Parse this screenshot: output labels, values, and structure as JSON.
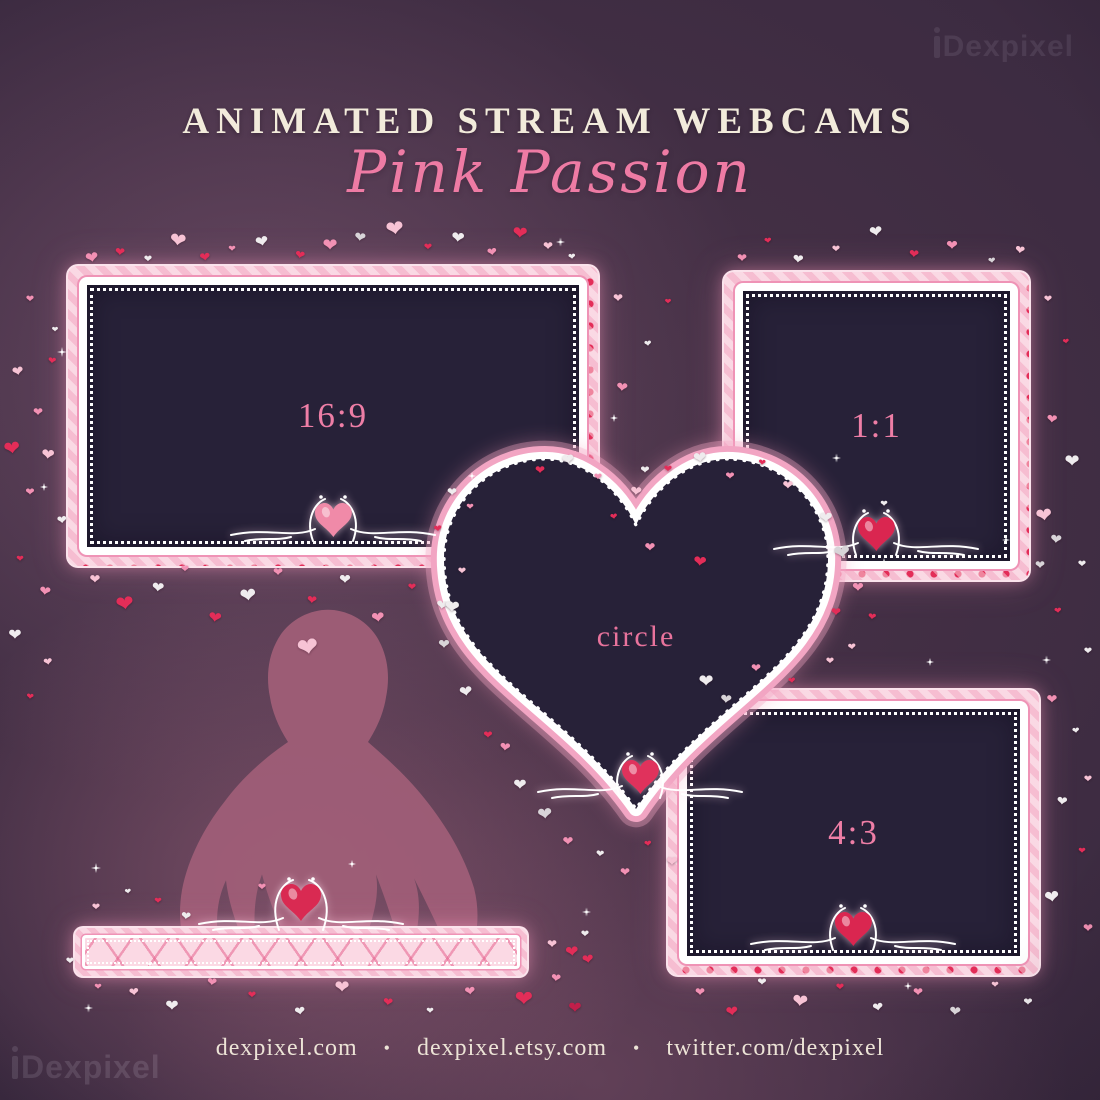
{
  "watermark": {
    "text": "Dexpixel"
  },
  "header": {
    "title": "ANIMATED STREAM WEBCAMS",
    "subtitle": "Pink Passion"
  },
  "frames": [
    {
      "id": "16-9",
      "label": "16:9",
      "ornament_color": "#f08aa8"
    },
    {
      "id": "1-1",
      "label": "1:1",
      "ornament_color": "#da2650"
    },
    {
      "id": "circle",
      "label": "circle",
      "ornament_color": "#e0325c"
    },
    {
      "id": "4-3",
      "label": "4:3",
      "ornament_color": "#da2650"
    },
    {
      "id": "label-bar",
      "label": "",
      "ornament_color": "#d92a52"
    }
  ],
  "footer": {
    "separator": "•",
    "links": [
      "dexpixel.com",
      "dexpixel.etsy.com",
      "twitter.com/dexpixel"
    ]
  },
  "colors": {
    "background_dark": "#2e2136",
    "background_glow": "#855c78",
    "title_cream": "#f2ebdb",
    "subtitle_pink": "#ee7ba4",
    "frame_band_pink": "#f6bdd1",
    "frame_heart_red": "#e32d58",
    "frame_border_white": "#ffffff",
    "screen_dark": "#272138",
    "label_pink": "#ee7ea6",
    "silhouette": "#9f5e77",
    "heart_palette": {
      "r": "#e32d58",
      "c": "#c21f4a",
      "p": "#f291b4",
      "b": "#f7c3d5",
      "w": "#efecee",
      "s": "#d8d4d8"
    }
  },
  "decor": {
    "heart_glyph": "❤",
    "hearts": [
      [
        92,
        258,
        16,
        "p",
        -10
      ],
      [
        120,
        252,
        12,
        "r",
        5
      ],
      [
        148,
        260,
        10,
        "w",
        0
      ],
      [
        178,
        240,
        20,
        "b",
        8
      ],
      [
        205,
        258,
        13,
        "r",
        -6
      ],
      [
        232,
        250,
        9,
        "p",
        0
      ],
      [
        262,
        242,
        16,
        "w",
        -12
      ],
      [
        300,
        255,
        12,
        "r",
        10
      ],
      [
        330,
        246,
        18,
        "p",
        0
      ],
      [
        360,
        238,
        14,
        "s",
        8
      ],
      [
        395,
        230,
        22,
        "b",
        -8
      ],
      [
        428,
        248,
        10,
        "r",
        0
      ],
      [
        458,
        238,
        16,
        "w",
        6
      ],
      [
        492,
        252,
        12,
        "p",
        -8
      ],
      [
        520,
        234,
        18,
        "r",
        4
      ],
      [
        548,
        246,
        12,
        "b",
        0
      ],
      [
        572,
        258,
        9,
        "w",
        -5
      ],
      [
        30,
        300,
        10,
        "p",
        0
      ],
      [
        55,
        330,
        8,
        "w",
        0
      ],
      [
        18,
        372,
        14,
        "b",
        -10
      ],
      [
        52,
        362,
        10,
        "r",
        6
      ],
      [
        38,
        412,
        12,
        "p",
        0
      ],
      [
        12,
        448,
        20,
        "r",
        -8
      ],
      [
        48,
        455,
        16,
        "b",
        6
      ],
      [
        30,
        492,
        11,
        "p",
        0
      ],
      [
        62,
        520,
        12,
        "w",
        -6
      ],
      [
        20,
        560,
        9,
        "r",
        0
      ],
      [
        45,
        592,
        14,
        "p",
        8
      ],
      [
        15,
        635,
        16,
        "w",
        0
      ],
      [
        48,
        662,
        11,
        "b",
        -8
      ],
      [
        30,
        698,
        9,
        "r",
        5
      ],
      [
        95,
        580,
        13,
        "b",
        0
      ],
      [
        125,
        605,
        22,
        "r",
        -8
      ],
      [
        158,
        588,
        15,
        "w",
        6
      ],
      [
        185,
        570,
        10,
        "p",
        0
      ],
      [
        215,
        618,
        16,
        "r",
        8
      ],
      [
        248,
        595,
        20,
        "w",
        -6
      ],
      [
        278,
        572,
        12,
        "p",
        0
      ],
      [
        308,
        648,
        26,
        "b",
        -10
      ],
      [
        312,
        600,
        12,
        "r",
        5
      ],
      [
        345,
        580,
        14,
        "w",
        0
      ],
      [
        378,
        618,
        16,
        "p",
        -6
      ],
      [
        412,
        588,
        10,
        "r",
        0
      ],
      [
        442,
        606,
        14,
        "w",
        8
      ],
      [
        462,
        572,
        10,
        "b",
        0
      ],
      [
        618,
        298,
        12,
        "b",
        0
      ],
      [
        648,
        345,
        9,
        "w",
        -6
      ],
      [
        668,
        302,
        8,
        "r",
        0
      ],
      [
        622,
        388,
        14,
        "p",
        6
      ],
      [
        645,
        470,
        11,
        "w",
        0
      ],
      [
        614,
        518,
        9,
        "r",
        -8
      ],
      [
        650,
        548,
        13,
        "p",
        0
      ],
      [
        700,
        562,
        16,
        "r",
        6
      ],
      [
        742,
        258,
        12,
        "p",
        0
      ],
      [
        768,
        242,
        9,
        "r",
        -5
      ],
      [
        798,
        260,
        13,
        "w",
        6
      ],
      [
        836,
        250,
        10,
        "b",
        0
      ],
      [
        876,
        232,
        16,
        "w",
        -8
      ],
      [
        914,
        254,
        12,
        "r",
        5
      ],
      [
        952,
        246,
        14,
        "p",
        0
      ],
      [
        992,
        262,
        9,
        "s",
        -6
      ],
      [
        1020,
        250,
        12,
        "b",
        8
      ],
      [
        1048,
        300,
        10,
        "b",
        0
      ],
      [
        1066,
        342,
        8,
        "r",
        -6
      ],
      [
        1052,
        420,
        13,
        "p",
        5
      ],
      [
        1072,
        462,
        18,
        "w",
        0
      ],
      [
        1044,
        515,
        20,
        "b",
        -8
      ],
      [
        1056,
        540,
        14,
        "s",
        6
      ],
      [
        1082,
        565,
        10,
        "w",
        0
      ],
      [
        1040,
        565,
        12,
        "s",
        0
      ],
      [
        1058,
        612,
        9,
        "r",
        -5
      ],
      [
        1088,
        652,
        10,
        "w",
        0
      ],
      [
        452,
        492,
        12,
        "w",
        0
      ],
      [
        438,
        530,
        10,
        "r",
        -6
      ],
      [
        470,
        508,
        9,
        "p",
        0
      ],
      [
        452,
        608,
        18,
        "w",
        6
      ],
      [
        444,
        645,
        14,
        "s",
        0
      ],
      [
        466,
        692,
        16,
        "w",
        -8
      ],
      [
        488,
        735,
        11,
        "r",
        0
      ],
      [
        505,
        748,
        13,
        "p",
        6
      ],
      [
        520,
        785,
        16,
        "w",
        0
      ],
      [
        545,
        815,
        18,
        "s",
        -6
      ],
      [
        568,
        842,
        13,
        "p",
        0
      ],
      [
        600,
        855,
        10,
        "w",
        5
      ],
      [
        625,
        872,
        12,
        "p",
        0
      ],
      [
        648,
        845,
        9,
        "r",
        -5
      ],
      [
        672,
        862,
        14,
        "b",
        0
      ],
      [
        540,
        470,
        12,
        "r",
        0
      ],
      [
        568,
        460,
        15,
        "w",
        -6
      ],
      [
        598,
        478,
        10,
        "p",
        0
      ],
      [
        636,
        492,
        14,
        "b",
        6
      ],
      [
        668,
        470,
        10,
        "r",
        0
      ],
      [
        700,
        458,
        16,
        "w",
        -8
      ],
      [
        730,
        476,
        11,
        "p",
        0
      ],
      [
        762,
        464,
        9,
        "r",
        5
      ],
      [
        788,
        486,
        13,
        "b",
        0
      ],
      [
        826,
        518,
        16,
        "w",
        0
      ],
      [
        842,
        552,
        20,
        "s",
        -8
      ],
      [
        858,
        588,
        14,
        "p",
        0
      ],
      [
        872,
        618,
        10,
        "r",
        6
      ],
      [
        884,
        505,
        9,
        "w",
        0
      ],
      [
        836,
        612,
        12,
        "r",
        0
      ],
      [
        852,
        648,
        10,
        "b",
        -5
      ],
      [
        706,
        682,
        18,
        "w",
        0
      ],
      [
        726,
        700,
        14,
        "s",
        6
      ],
      [
        756,
        668,
        12,
        "p",
        0
      ],
      [
        792,
        682,
        9,
        "r",
        -6
      ],
      [
        830,
        662,
        10,
        "b",
        0
      ],
      [
        1052,
        700,
        13,
        "p",
        0
      ],
      [
        1076,
        732,
        9,
        "w",
        -6
      ],
      [
        1088,
        780,
        10,
        "b",
        0
      ],
      [
        1062,
        802,
        13,
        "w",
        6
      ],
      [
        1082,
        852,
        9,
        "r",
        0
      ],
      [
        1052,
        898,
        18,
        "w",
        -8
      ],
      [
        1088,
        928,
        12,
        "p",
        0
      ],
      [
        700,
        992,
        12,
        "p",
        0
      ],
      [
        732,
        1012,
        15,
        "r",
        -6
      ],
      [
        762,
        982,
        11,
        "w",
        0
      ],
      [
        800,
        1002,
        19,
        "b",
        6
      ],
      [
        840,
        988,
        10,
        "r",
        0
      ],
      [
        878,
        1008,
        13,
        "w",
        -8
      ],
      [
        918,
        992,
        12,
        "p",
        0
      ],
      [
        955,
        1012,
        14,
        "s",
        6
      ],
      [
        995,
        986,
        9,
        "b",
        0
      ],
      [
        1028,
        1002,
        11,
        "w",
        0
      ],
      [
        96,
        908,
        10,
        "b",
        0
      ],
      [
        128,
        892,
        8,
        "w",
        -6
      ],
      [
        158,
        902,
        9,
        "r",
        0
      ],
      [
        186,
        916,
        12,
        "w",
        6
      ],
      [
        262,
        888,
        10,
        "p",
        0
      ],
      [
        98,
        988,
        9,
        "p",
        0
      ],
      [
        134,
        992,
        12,
        "b",
        -6
      ],
      [
        172,
        1006,
        16,
        "w",
        0
      ],
      [
        212,
        982,
        12,
        "p",
        6
      ],
      [
        252,
        996,
        10,
        "r",
        0
      ],
      [
        300,
        1012,
        13,
        "w",
        -8
      ],
      [
        342,
        988,
        18,
        "b",
        0
      ],
      [
        388,
        1002,
        12,
        "r",
        6
      ],
      [
        430,
        1012,
        9,
        "w",
        0
      ],
      [
        470,
        992,
        13,
        "p",
        -6
      ],
      [
        524,
        1000,
        22,
        "r",
        0
      ],
      [
        556,
        978,
        12,
        "p",
        6
      ],
      [
        575,
        1008,
        16,
        "c",
        0
      ],
      [
        588,
        960,
        14,
        "r",
        -8
      ],
      [
        70,
        962,
        10,
        "w",
        0
      ],
      [
        552,
        944,
        12,
        "b",
        0
      ],
      [
        572,
        952,
        16,
        "r",
        -6
      ],
      [
        585,
        935,
        10,
        "w",
        0
      ]
    ],
    "sparkles": [
      [
        62,
        352,
        10
      ],
      [
        44,
        487,
        8
      ],
      [
        560,
        242,
        9
      ],
      [
        614,
        418,
        8
      ],
      [
        472,
        476,
        8
      ],
      [
        836,
        458,
        9
      ],
      [
        884,
        562,
        8
      ],
      [
        930,
        662,
        8
      ],
      [
        1046,
        660,
        9
      ],
      [
        96,
        868,
        10
      ],
      [
        88,
        1008,
        9
      ],
      [
        150,
        964,
        8
      ],
      [
        586,
        912,
        9
      ],
      [
        908,
        986,
        8
      ],
      [
        352,
        864,
        8
      ],
      [
        1006,
        540,
        8
      ]
    ]
  }
}
